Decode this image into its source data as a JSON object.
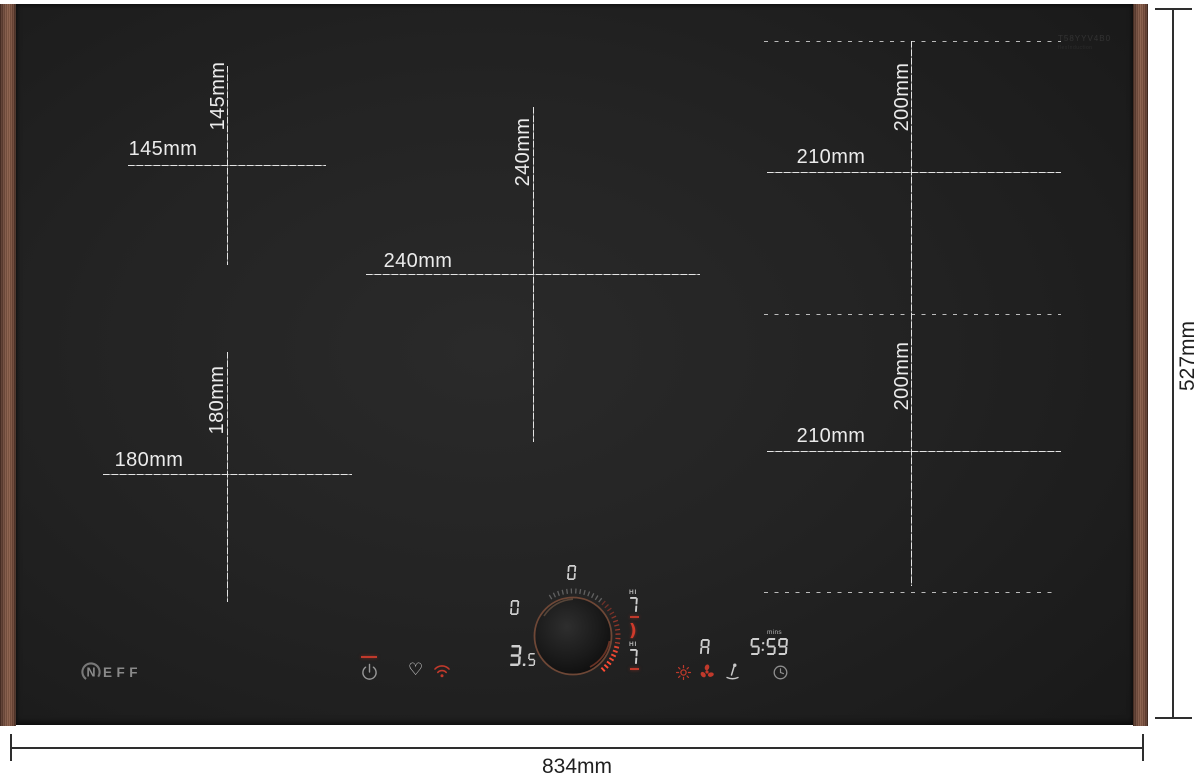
{
  "colors": {
    "accent_red": "#cf3a2b",
    "copper_trim": "#7b5342",
    "glass_black": "#232323",
    "display_grey": "#cfcfcf",
    "dim_line_dark": "#2e2e2e",
    "dim_line_light": "#e3e3e3"
  },
  "hob": {
    "brand": "NEFF",
    "brand_n": "N",
    "brand_eff": "EFF",
    "etching_line1": "T58YYV4B0",
    "etching_line2": "flexInduction"
  },
  "overall_dimensions": {
    "width_label": "834mm",
    "height_label": "527mm"
  },
  "zones": {
    "top_left": {
      "width_label": "145mm",
      "height_label": "145mm"
    },
    "center": {
      "width_label": "240mm",
      "height_label": "240mm"
    },
    "bottom_left": {
      "width_label": "180mm",
      "height_label": "180mm"
    },
    "right_top": {
      "width_label": "210mm",
      "height_label": "200mm"
    },
    "right_bottom": {
      "width_label": "210mm",
      "height_label": "200mm"
    }
  },
  "control_panel": {
    "power_level_top": "0",
    "power_level_left": "0",
    "power_level_main": "3.5",
    "right_zone_top": {
      "boost_label": "HI",
      "level": "7"
    },
    "pan_symbol": ")",
    "right_zone_bottom": {
      "boost_label": "HI",
      "level": "7"
    },
    "auto_indicator": "A",
    "timer_unit": "mins",
    "timer_value": "5:59",
    "icons": {
      "power": "power-icon",
      "favorite": "heart-icon",
      "wifi": "wifi-icon",
      "warming": "warming-sun-icon",
      "hood_fan": "fan-icon",
      "cleaning": "cleaning-wand-icon",
      "timer": "clock-icon"
    }
  }
}
